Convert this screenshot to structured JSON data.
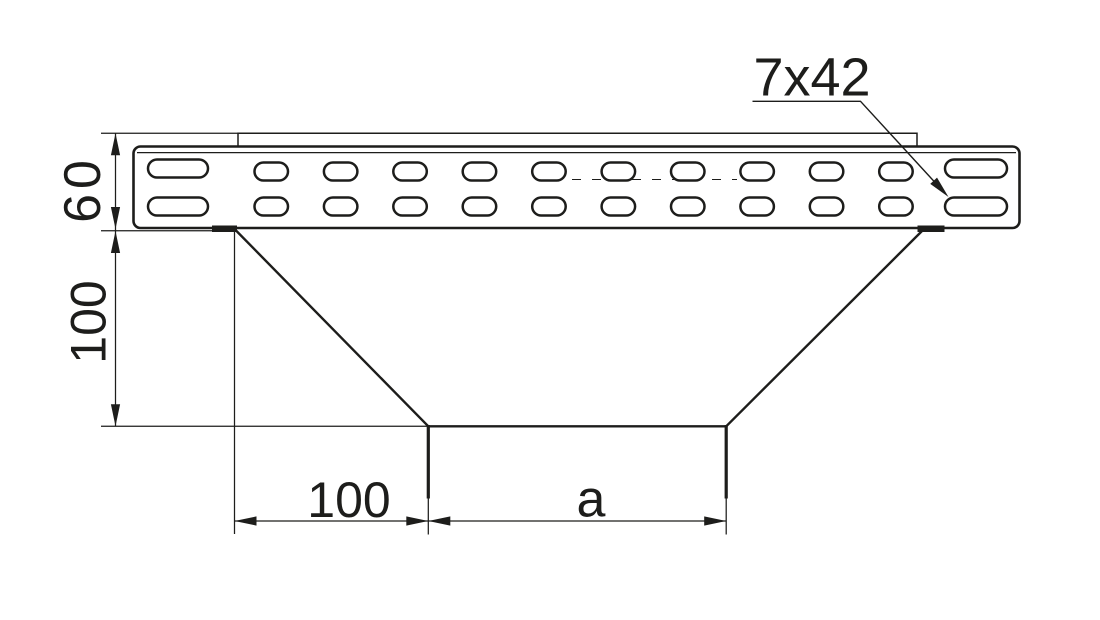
{
  "drawing": {
    "labels": {
      "dim_rail_height": "60",
      "dim_branch_height": "100",
      "dim_bottom_left": "100",
      "dim_bottom_right": "a",
      "slot_callout": "7x42"
    },
    "colors": {
      "line": "#1d1d1b",
      "background": "#ffffff"
    }
  }
}
